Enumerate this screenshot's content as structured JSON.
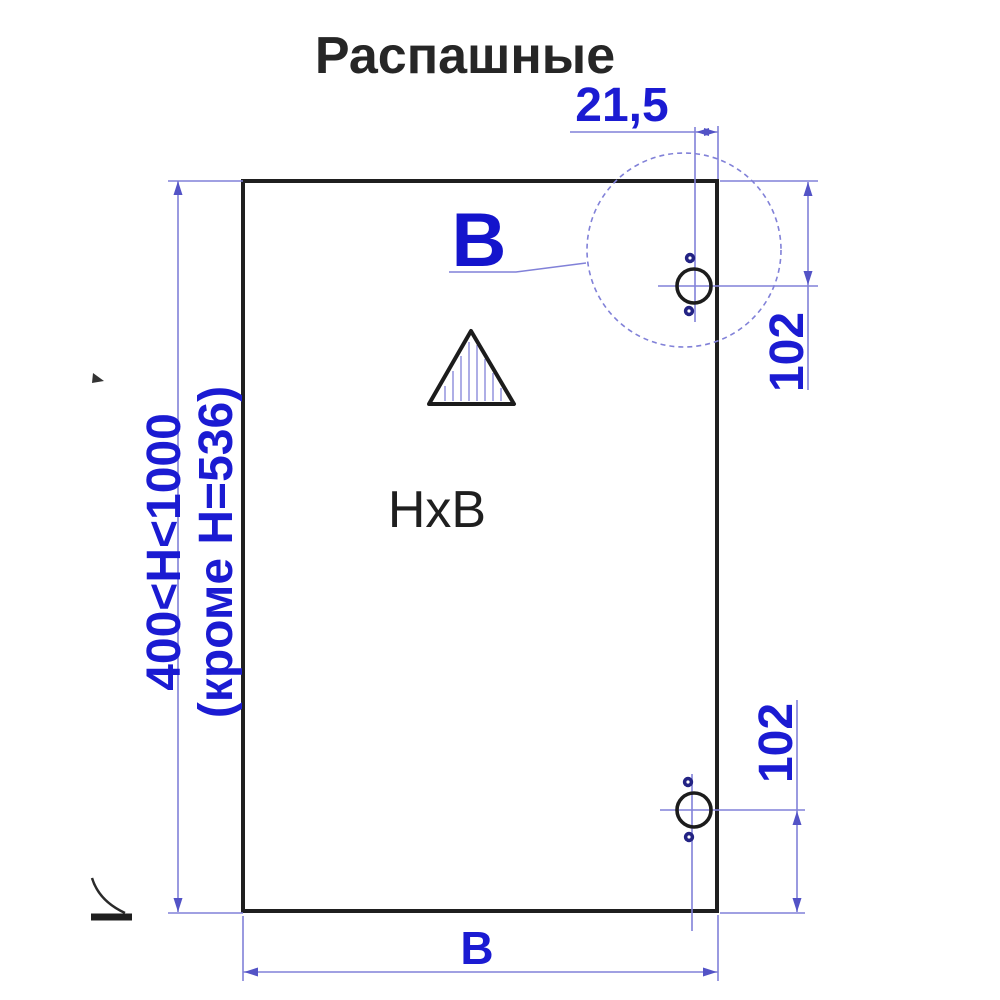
{
  "title": "Распашные",
  "colors": {
    "dimension_text": "#1b1bd2",
    "dimension_line": "#8181d8",
    "outline_black": "#1f1f1f",
    "hole_dot": "#232384"
  },
  "labels": {
    "detail_view": "B",
    "panel_size": "HxB",
    "width_dim": "B"
  },
  "dimensions": {
    "hinge_edge_offset": "21,5",
    "hinge_top_distance": "102",
    "hinge_bottom_distance": "102",
    "height_range": "400<H<1000",
    "height_exception": "(кроме H=536)"
  }
}
